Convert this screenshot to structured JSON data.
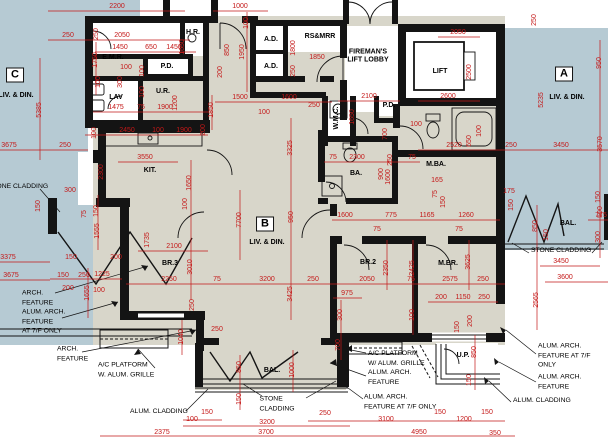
{
  "colors": {
    "red": "#c41818",
    "blue": "#b6cad3",
    "floor": "#d8d6ca",
    "wall": "#141414"
  },
  "units": [
    [
      "C",
      15,
      75
    ],
    [
      "B",
      265,
      224
    ],
    [
      "A",
      564,
      74
    ]
  ],
  "rooms": [
    [
      "E.M.R.",
      113,
      58,
      0
    ],
    [
      "H.R.",
      193,
      33,
      0
    ],
    [
      "P.D.",
      167,
      67,
      0
    ],
    [
      "LAV",
      116,
      98,
      0
    ],
    [
      "U.R.",
      163,
      92,
      0
    ],
    [
      "A.D.",
      271,
      40,
      0
    ],
    [
      "A.D.",
      271,
      67,
      0
    ],
    [
      "RS&MRR",
      320,
      37,
      0
    ],
    [
      "FIREMAN'S\nLIFT LOBBY",
      368,
      56,
      0
    ],
    [
      "LIFT",
      440,
      72,
      0
    ],
    [
      "W.M.C.",
      337,
      118,
      1
    ],
    [
      "P.D.",
      389,
      106,
      0
    ],
    [
      "M.BA.",
      436,
      165,
      0
    ],
    [
      "KIT.",
      150,
      171,
      0
    ],
    [
      "BA.",
      356,
      174,
      0
    ],
    [
      "BR.3",
      170,
      264,
      0
    ],
    [
      "BR.2",
      368,
      263,
      0
    ],
    [
      "M.BR.",
      448,
      264,
      0
    ],
    [
      "BAL.",
      272,
      371,
      0
    ],
    [
      "BAL.",
      568,
      224,
      0
    ],
    [
      "U.P.",
      463,
      356,
      0
    ],
    [
      "LIV. & DIN.",
      16,
      96,
      0
    ],
    [
      "LIV. & DIN.",
      567,
      98,
      0
    ],
    [
      "LIV. & DIN.",
      267,
      243,
      0
    ]
  ],
  "notes": [
    [
      "STONE CLADDING",
      18,
      187,
      "c"
    ],
    [
      "ARCH.\nFEATURE",
      22,
      298,
      "l"
    ],
    [
      "ALUM. ARCH.\nFEATURE\nAT 7/F ONLY",
      22,
      322,
      "l"
    ],
    [
      "ARCH.\nFEATURE",
      57,
      354,
      "l"
    ],
    [
      "A/C PLATFORM\nW. ALUM. GRILLE",
      98,
      370,
      "l"
    ],
    [
      "ALUM. CLADDING",
      130,
      412,
      "l"
    ],
    [
      "STONE\nCLADDING",
      277,
      404,
      "c"
    ],
    [
      "A/C PLATFORM\nW/ ALUM. GRILLE\nALUM. ARCH.\nFEATURE",
      368,
      368,
      "l"
    ],
    [
      "ALUM. ARCH.\nFEATURE AT 7/F ONLY",
      364,
      402,
      "l"
    ],
    [
      "ALUM. ARCH.\nFEATURE AT 7/F ONLY",
      538,
      356,
      "l"
    ],
    [
      "ALUM. ARCH.\nFEATURE",
      538,
      382,
      "l"
    ],
    [
      "ALUM. CLADDING",
      513,
      401,
      "l"
    ],
    [
      "STONE CLADDING",
      531,
      251,
      "l"
    ]
  ],
  "dims": [
    [
      "2200",
      117,
      7,
      0
    ],
    [
      "1000",
      240,
      7,
      0
    ],
    [
      "100",
      247,
      23,
      1
    ],
    [
      "250",
      68,
      36,
      0
    ],
    [
      "2050",
      122,
      36,
      0
    ],
    [
      "250",
      97,
      34,
      1
    ],
    [
      "1450",
      120,
      48,
      0
    ],
    [
      "650",
      151,
      48,
      0
    ],
    [
      "1450",
      174,
      48,
      0
    ],
    [
      "1650",
      183,
      47,
      1
    ],
    [
      "850",
      228,
      50,
      1
    ],
    [
      "1750",
      96,
      60,
      1
    ],
    [
      "100",
      126,
      68,
      0
    ],
    [
      "100",
      99,
      82,
      1
    ],
    [
      "300",
      121,
      82,
      1
    ],
    [
      "100",
      143,
      71,
      1
    ],
    [
      "100",
      143,
      92,
      1
    ],
    [
      "5385",
      40,
      110,
      1
    ],
    [
      "1475",
      116,
      108,
      0
    ],
    [
      "75",
      141,
      108,
      0
    ],
    [
      "1900",
      165,
      108,
      0
    ],
    [
      "1200",
      176,
      103,
      1
    ],
    [
      "1850",
      212,
      110,
      1
    ],
    [
      "100",
      95,
      133,
      1
    ],
    [
      "2450",
      127,
      131,
      0
    ],
    [
      "100",
      158,
      131,
      0
    ],
    [
      "1900",
      184,
      131,
      0
    ],
    [
      "200",
      204,
      130,
      1
    ],
    [
      "3675",
      9,
      146,
      0
    ],
    [
      "250",
      65,
      146,
      0
    ],
    [
      "1950",
      243,
      52,
      1
    ],
    [
      "200",
      221,
      72,
      1
    ],
    [
      "1500",
      240,
      98,
      0
    ],
    [
      "1600",
      289,
      98,
      0
    ],
    [
      "100",
      264,
      113,
      0
    ],
    [
      "250",
      314,
      106,
      0
    ],
    [
      "1800",
      294,
      48,
      1
    ],
    [
      "1850",
      317,
      58,
      0
    ],
    [
      "250",
      294,
      71,
      1
    ],
    [
      "2100",
      369,
      97,
      0
    ],
    [
      "1650",
      353,
      117,
      1
    ],
    [
      "700",
      386,
      134,
      1
    ],
    [
      "2600",
      448,
      97,
      0
    ],
    [
      "2050",
      458,
      33,
      0
    ],
    [
      "2500",
      470,
      72,
      1
    ],
    [
      "250",
      535,
      20,
      1
    ],
    [
      "950",
      600,
      63,
      1
    ],
    [
      "5235",
      542,
      100,
      1
    ],
    [
      "100",
      416,
      125,
      0
    ],
    [
      "250",
      391,
      160,
      1
    ],
    [
      "900",
      382,
      174,
      1
    ],
    [
      "100",
      480,
      131,
      1
    ],
    [
      "650",
      470,
      141,
      1
    ],
    [
      "2520",
      454,
      146,
      0
    ],
    [
      "250",
      511,
      146,
      0
    ],
    [
      "3450",
      561,
      146,
      0
    ],
    [
      "3570",
      601,
      144,
      1
    ],
    [
      "3550",
      145,
      158,
      0
    ],
    [
      "2300",
      102,
      172,
      1
    ],
    [
      "300",
      70,
      191,
      0
    ],
    [
      "150",
      39,
      206,
      1
    ],
    [
      "1650",
      190,
      183,
      1
    ],
    [
      "100",
      186,
      204,
      1
    ],
    [
      "7700",
      240,
      220,
      1
    ],
    [
      "3325",
      291,
      148,
      1
    ],
    [
      "950",
      292,
      217,
      1
    ],
    [
      "75",
      333,
      158,
      0
    ],
    [
      "2300",
      357,
      158,
      0
    ],
    [
      "75",
      412,
      158,
      0
    ],
    [
      "1600",
      389,
      177,
      1
    ],
    [
      "165",
      437,
      181,
      0
    ],
    [
      "75",
      436,
      194,
      1
    ],
    [
      "150",
      444,
      202,
      1
    ],
    [
      "1600",
      345,
      216,
      0
    ],
    [
      "775",
      391,
      216,
      0
    ],
    [
      "1165",
      427,
      216,
      0
    ],
    [
      "1260",
      466,
      216,
      0
    ],
    [
      "775",
      601,
      216,
      0
    ],
    [
      "75",
      377,
      230,
      0
    ],
    [
      "75",
      459,
      230,
      0
    ],
    [
      "175",
      509,
      192,
      0
    ],
    [
      "150",
      512,
      205,
      1
    ],
    [
      "850",
      536,
      226,
      1
    ],
    [
      "150",
      547,
      235,
      1
    ],
    [
      "150",
      599,
      197,
      1
    ],
    [
      "500",
      601,
      212,
      1
    ],
    [
      "300",
      599,
      237,
      1
    ],
    [
      "1735",
      148,
      240,
      1
    ],
    [
      "2100",
      174,
      247,
      0
    ],
    [
      "3010",
      191,
      267,
      1
    ],
    [
      "75",
      85,
      214,
      1
    ],
    [
      "150",
      97,
      211,
      1
    ],
    [
      "1555",
      98,
      231,
      1
    ],
    [
      "3375",
      8,
      258,
      0
    ],
    [
      "150",
      71,
      258,
      0
    ],
    [
      "200",
      116,
      258,
      0
    ],
    [
      "3675",
      11,
      276,
      0
    ],
    [
      "150",
      63,
      276,
      0
    ],
    [
      "250",
      84,
      276,
      0
    ],
    [
      "1225",
      102,
      275,
      0
    ],
    [
      "200",
      68,
      289,
      0
    ],
    [
      "100",
      99,
      291,
      0
    ],
    [
      "1655",
      88,
      293,
      1
    ],
    [
      "2250",
      169,
      280,
      0
    ],
    [
      "250",
      193,
      305,
      1
    ],
    [
      "1040",
      182,
      337,
      1
    ],
    [
      "75",
      217,
      280,
      0
    ],
    [
      "3200",
      267,
      280,
      0
    ],
    [
      "250",
      313,
      280,
      0
    ],
    [
      "250",
      217,
      330,
      0
    ],
    [
      "850",
      240,
      367,
      1
    ],
    [
      "1000",
      293,
      370,
      1
    ],
    [
      "3425",
      291,
      294,
      1
    ],
    [
      "150",
      240,
      399,
      1
    ],
    [
      "100",
      192,
      420,
      0
    ],
    [
      "150",
      207,
      413,
      0
    ],
    [
      "3200",
      267,
      423,
      0
    ],
    [
      "3700",
      266,
      433,
      0
    ],
    [
      "2375",
      162,
      433,
      0
    ],
    [
      "2050",
      367,
      280,
      0
    ],
    [
      "75",
      411,
      280,
      0
    ],
    [
      "2575",
      450,
      280,
      0
    ],
    [
      "250",
      483,
      280,
      0
    ],
    [
      "975",
      347,
      294,
      0
    ],
    [
      "300",
      341,
      315,
      1
    ],
    [
      "700",
      339,
      345,
      1
    ],
    [
      "2350",
      387,
      268,
      1
    ],
    [
      "2425",
      413,
      268,
      1
    ],
    [
      "3625",
      469,
      262,
      1
    ],
    [
      "200",
      441,
      298,
      0
    ],
    [
      "1150",
      463,
      298,
      0
    ],
    [
      "250",
      484,
      298,
      0
    ],
    [
      "100",
      413,
      315,
      1
    ],
    [
      "150",
      458,
      327,
      1
    ],
    [
      "200",
      471,
      321,
      1
    ],
    [
      "850",
      475,
      352,
      1
    ],
    [
      "150",
      470,
      380,
      1
    ],
    [
      "2565",
      537,
      300,
      1
    ],
    [
      "3450",
      561,
      262,
      0
    ],
    [
      "3600",
      565,
      278,
      0
    ],
    [
      "250",
      325,
      414,
      0
    ],
    [
      "3100",
      386,
      420,
      0
    ],
    [
      "150",
      440,
      413,
      0
    ],
    [
      "1200",
      464,
      420,
      0
    ],
    [
      "150",
      487,
      413,
      0
    ],
    [
      "4950",
      419,
      433,
      0
    ],
    [
      "350",
      495,
      434,
      0
    ]
  ]
}
